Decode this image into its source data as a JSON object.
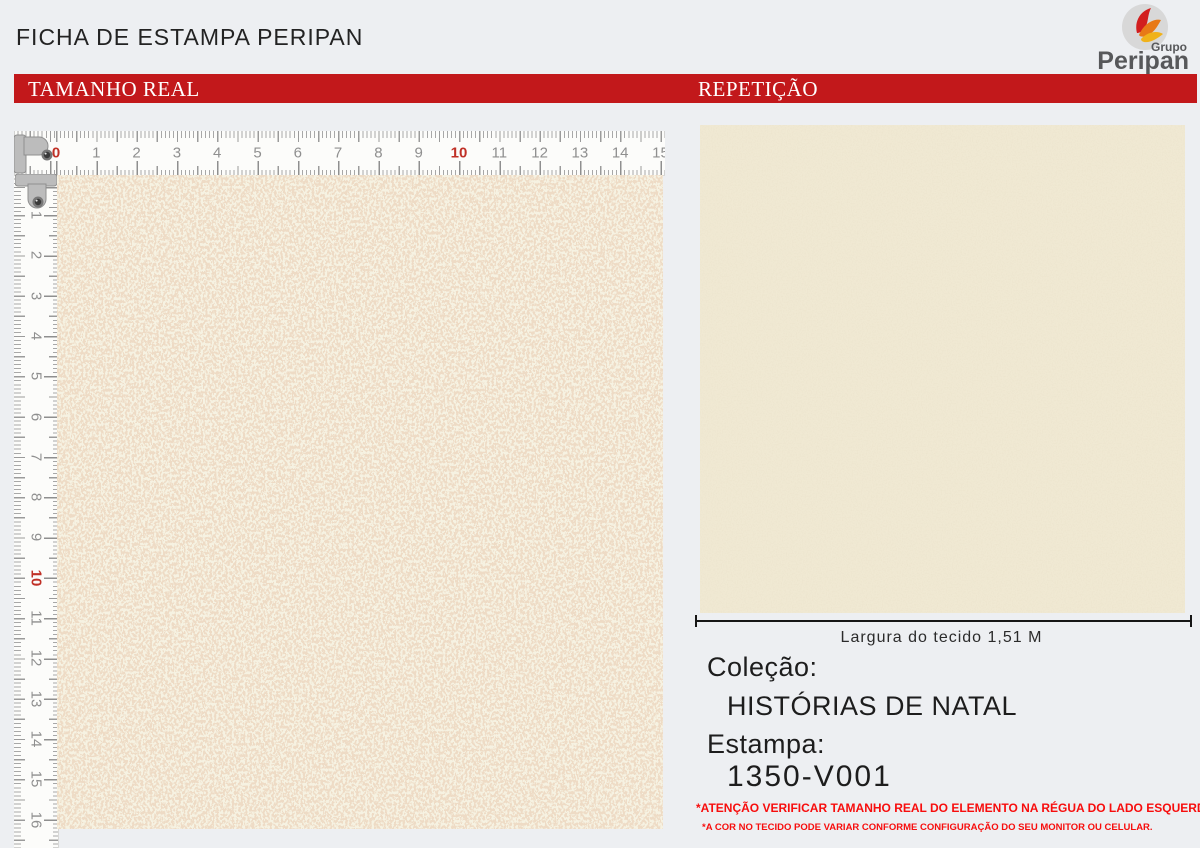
{
  "page": {
    "title": "FICHA DE ESTAMPA PERIPAN",
    "background": "#edeff2"
  },
  "logo": {
    "grupo": "Grupo",
    "name": "Peripan",
    "circle_color": "#d8d8d8",
    "flame_colors": [
      "#d21e1e",
      "#e87917",
      "#f0b21b"
    ],
    "text_color": "#57585a"
  },
  "banner": {
    "color": "#c2181b",
    "text_color": "#ffffff",
    "left_label": "TAMANHO REAL",
    "right_label": "REPETIÇÃO"
  },
  "rulers": {
    "unit_px_per_cm": 40.3,
    "tick_color": "#9b9b9b",
    "number_color": "#8f8f8f",
    "red_number_color": "#c03026",
    "horizontal": {
      "numbers": [
        "0",
        "1",
        "2",
        "3",
        "4",
        "5",
        "6",
        "7",
        "8",
        "9",
        "10",
        "11",
        "12",
        "13",
        "14",
        "15"
      ],
      "red_numbers": [
        "0",
        "10"
      ]
    },
    "vertical": {
      "numbers": [
        "1",
        "2",
        "3",
        "4",
        "5",
        "6",
        "7",
        "8",
        "9",
        "10",
        "11",
        "12",
        "13",
        "14",
        "15",
        "16"
      ],
      "red_numbers": [
        "10"
      ]
    }
  },
  "swatches": {
    "real_size": {
      "base_color": "#f6f2e2",
      "speckle_color": "#d9b58e"
    },
    "repeat": {
      "base_color": "#f0e9d3"
    }
  },
  "measure": {
    "label": "Largura do tecido 1,51 M"
  },
  "info": {
    "collection_label": "Coleção:",
    "collection_value": "HISTÓRIAS DE NATAL",
    "print_label": "Estampa:",
    "print_value": "1350-V001"
  },
  "warnings": {
    "line1": "*ATENÇÃO VERIFICAR TAMANHO REAL DO ELEMENTO NA RÉGUA DO LADO ESQUERDO",
    "line2": "*A COR NO TECIDO PODE VARIAR CONFORME CONFIGURAÇÃO DO SEU MONITOR OU CELULAR."
  }
}
